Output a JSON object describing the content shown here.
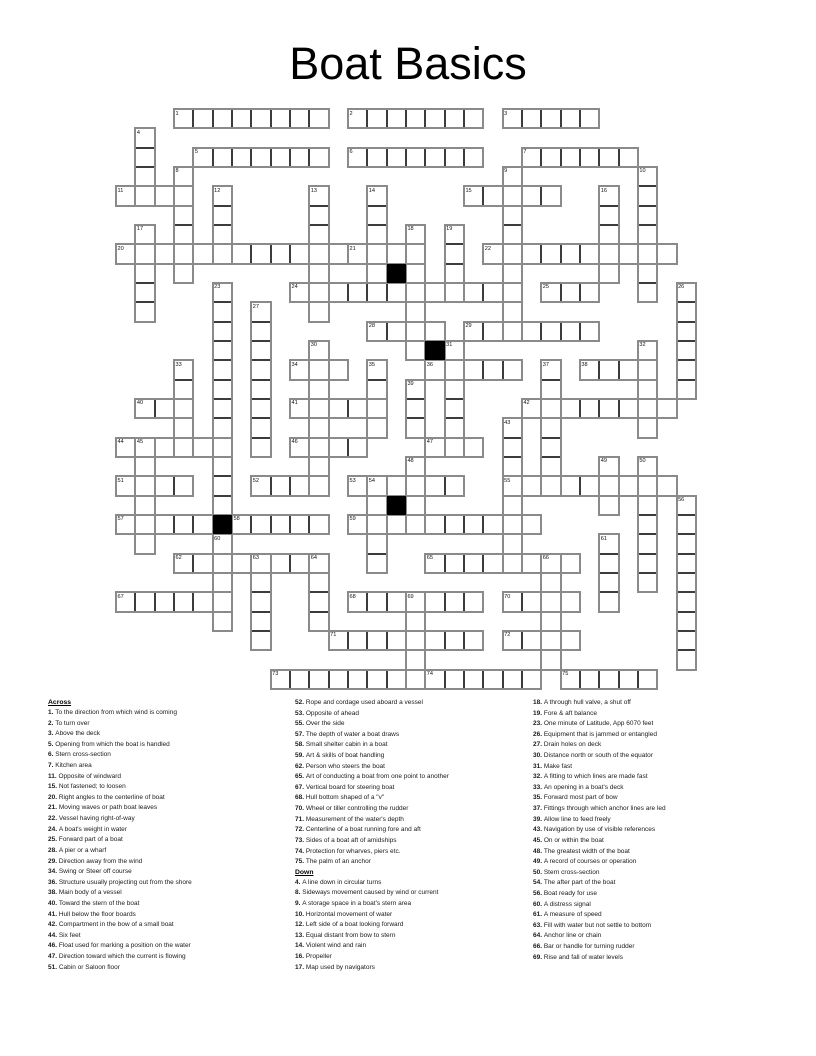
{
  "title": "Boat Basics",
  "grid": {
    "rows": 30,
    "cols": 30,
    "origin_x": 116,
    "origin_y": 109,
    "cell_size": 19.33,
    "colors": {
      "cell_border": "#3c3c3c",
      "word_outline": "#8a8a8a",
      "black_cell": "#000000",
      "cell_bg": "#ffffff"
    },
    "black_cells": [
      [
        8,
        14
      ],
      [
        12,
        16
      ],
      [
        20,
        14
      ],
      [
        21,
        5
      ]
    ],
    "words": [
      {
        "num": 1,
        "dir": "across",
        "row": 0,
        "col": 3,
        "len": 8
      },
      {
        "num": 2,
        "dir": "across",
        "row": 0,
        "col": 12,
        "len": 7
      },
      {
        "num": 3,
        "dir": "across",
        "row": 0,
        "col": 20,
        "len": 5
      },
      {
        "num": 4,
        "dir": "down",
        "row": 1,
        "col": 1,
        "len": 4
      },
      {
        "num": 5,
        "dir": "across",
        "row": 2,
        "col": 4,
        "len": 7
      },
      {
        "num": 6,
        "dir": "across",
        "row": 2,
        "col": 12,
        "len": 7
      },
      {
        "num": 7,
        "dir": "across",
        "row": 2,
        "col": 21,
        "len": 6
      },
      {
        "num": 8,
        "dir": "down",
        "row": 3,
        "col": 3,
        "len": 6
      },
      {
        "num": 9,
        "dir": "down",
        "row": 3,
        "col": 20,
        "len": 9
      },
      {
        "num": 10,
        "dir": "down",
        "row": 3,
        "col": 27,
        "len": 7
      },
      {
        "num": 11,
        "dir": "across",
        "row": 4,
        "col": 0,
        "len": 4
      },
      {
        "num": 12,
        "dir": "down",
        "row": 4,
        "col": 5,
        "len": 4
      },
      {
        "num": 13,
        "dir": "down",
        "row": 4,
        "col": 10,
        "len": 7
      },
      {
        "num": 14,
        "dir": "down",
        "row": 4,
        "col": 13,
        "len": 5
      },
      {
        "num": 15,
        "dir": "across",
        "row": 4,
        "col": 18,
        "len": 5
      },
      {
        "num": 16,
        "dir": "down",
        "row": 4,
        "col": 25,
        "len": 5
      },
      {
        "num": 17,
        "dir": "down",
        "row": 6,
        "col": 1,
        "len": 5
      },
      {
        "num": 18,
        "dir": "down",
        "row": 6,
        "col": 15,
        "len": 7
      },
      {
        "num": 19,
        "dir": "down",
        "row": 6,
        "col": 17,
        "len": 4
      },
      {
        "num": 20,
        "dir": "across",
        "row": 7,
        "col": 0,
        "len": 12
      },
      {
        "num": 21,
        "dir": "across",
        "row": 7,
        "col": 12,
        "len": 4
      },
      {
        "num": 22,
        "dir": "across",
        "row": 7,
        "col": 19,
        "len": 10
      },
      {
        "num": 23,
        "dir": "down",
        "row": 9,
        "col": 5,
        "len": 12
      },
      {
        "num": 24,
        "dir": "across",
        "row": 9,
        "col": 9,
        "len": 12
      },
      {
        "num": 25,
        "dir": "across",
        "row": 9,
        "col": 22,
        "len": 3
      },
      {
        "num": 26,
        "dir": "down",
        "row": 9,
        "col": 29,
        "len": 6
      },
      {
        "num": 27,
        "dir": "down",
        "row": 10,
        "col": 7,
        "len": 8
      },
      {
        "num": 28,
        "dir": "across",
        "row": 11,
        "col": 13,
        "len": 4
      },
      {
        "num": 29,
        "dir": "across",
        "row": 11,
        "col": 18,
        "len": 7
      },
      {
        "num": 30,
        "dir": "down",
        "row": 12,
        "col": 10,
        "len": 8
      },
      {
        "num": 31,
        "dir": "down",
        "row": 12,
        "col": 17,
        "len": 6
      },
      {
        "num": 32,
        "dir": "down",
        "row": 12,
        "col": 27,
        "len": 5
      },
      {
        "num": 33,
        "dir": "down",
        "row": 13,
        "col": 3,
        "len": 5
      },
      {
        "num": 34,
        "dir": "across",
        "row": 13,
        "col": 9,
        "len": 3
      },
      {
        "num": 35,
        "dir": "down",
        "row": 13,
        "col": 13,
        "len": 4
      },
      {
        "num": 36,
        "dir": "across",
        "row": 13,
        "col": 16,
        "len": 5
      },
      {
        "num": 37,
        "dir": "down",
        "row": 13,
        "col": 22,
        "len": 7
      },
      {
        "num": 38,
        "dir": "across",
        "row": 13,
        "col": 24,
        "len": 4
      },
      {
        "num": 39,
        "dir": "down",
        "row": 14,
        "col": 15,
        "len": 3
      },
      {
        "num": 40,
        "dir": "across",
        "row": 15,
        "col": 1,
        "len": 3
      },
      {
        "num": 41,
        "dir": "across",
        "row": 15,
        "col": 9,
        "len": 5
      },
      {
        "num": 42,
        "dir": "across",
        "row": 15,
        "col": 21,
        "len": 8
      },
      {
        "num": 43,
        "dir": "down",
        "row": 16,
        "col": 20,
        "len": 8
      },
      {
        "num": 44,
        "dir": "across",
        "row": 17,
        "col": 0,
        "len": 6
      },
      {
        "num": 45,
        "dir": "down",
        "row": 17,
        "col": 1,
        "len": 6
      },
      {
        "num": 46,
        "dir": "across",
        "row": 17,
        "col": 9,
        "len": 4
      },
      {
        "num": 47,
        "dir": "across",
        "row": 17,
        "col": 16,
        "len": 3
      },
      {
        "num": 48,
        "dir": "down",
        "row": 18,
        "col": 15,
        "len": 4
      },
      {
        "num": 49,
        "dir": "down",
        "row": 18,
        "col": 25,
        "len": 3
      },
      {
        "num": 50,
        "dir": "down",
        "row": 18,
        "col": 27,
        "len": 7
      },
      {
        "num": 51,
        "dir": "across",
        "row": 19,
        "col": 0,
        "len": 4
      },
      {
        "num": 52,
        "dir": "across",
        "row": 19,
        "col": 7,
        "len": 4
      },
      {
        "num": 53,
        "dir": "across",
        "row": 19,
        "col": 12,
        "len": 6
      },
      {
        "num": 54,
        "dir": "down",
        "row": 19,
        "col": 13,
        "len": 5
      },
      {
        "num": 55,
        "dir": "across",
        "row": 19,
        "col": 20,
        "len": 9
      },
      {
        "num": 56,
        "dir": "down",
        "row": 20,
        "col": 29,
        "len": 9
      },
      {
        "num": 57,
        "dir": "across",
        "row": 21,
        "col": 0,
        "len": 5
      },
      {
        "num": 58,
        "dir": "across",
        "row": 21,
        "col": 6,
        "len": 5
      },
      {
        "num": 59,
        "dir": "across",
        "row": 21,
        "col": 12,
        "len": 10
      },
      {
        "num": 60,
        "dir": "down",
        "row": 22,
        "col": 5,
        "len": 5
      },
      {
        "num": 61,
        "dir": "down",
        "row": 22,
        "col": 25,
        "len": 4
      },
      {
        "num": 62,
        "dir": "across",
        "row": 23,
        "col": 3,
        "len": 8
      },
      {
        "num": 63,
        "dir": "down",
        "row": 23,
        "col": 7,
        "len": 5
      },
      {
        "num": 64,
        "dir": "down",
        "row": 23,
        "col": 10,
        "len": 4
      },
      {
        "num": 65,
        "dir": "across",
        "row": 23,
        "col": 16,
        "len": 8
      },
      {
        "num": 66,
        "dir": "down",
        "row": 23,
        "col": 22,
        "len": 6
      },
      {
        "num": 67,
        "dir": "across",
        "row": 25,
        "col": 0,
        "len": 6
      },
      {
        "num": 68,
        "dir": "across",
        "row": 25,
        "col": 12,
        "len": 7
      },
      {
        "num": 69,
        "dir": "down",
        "row": 25,
        "col": 15,
        "len": 5
      },
      {
        "num": 70,
        "dir": "across",
        "row": 25,
        "col": 20,
        "len": 4
      },
      {
        "num": 71,
        "dir": "across",
        "row": 27,
        "col": 11,
        "len": 8
      },
      {
        "num": 72,
        "dir": "across",
        "row": 27,
        "col": 20,
        "len": 4
      },
      {
        "num": 73,
        "dir": "across",
        "row": 29,
        "col": 8,
        "len": 8
      },
      {
        "num": 74,
        "dir": "across",
        "row": 29,
        "col": 16,
        "len": 6
      },
      {
        "num": 75,
        "dir": "across",
        "row": 29,
        "col": 23,
        "len": 5
      }
    ]
  },
  "clues": {
    "across_label": "Across",
    "down_label": "Down",
    "across": [
      {
        "num": "1.",
        "text": "To the direction from which wind is coming"
      },
      {
        "num": "2.",
        "text": "To turn over"
      },
      {
        "num": "3.",
        "text": "Above the deck"
      },
      {
        "num": "5.",
        "text": "Opening from which the boat is handled"
      },
      {
        "num": "6.",
        "text": "Stern cross-section"
      },
      {
        "num": "7.",
        "text": "Kitchen area"
      },
      {
        "num": "11.",
        "text": "Opposite of windward"
      },
      {
        "num": "15.",
        "text": "Not fastened; to loosen"
      },
      {
        "num": "20.",
        "text": "Right angles to the centerline of boat"
      },
      {
        "num": "21.",
        "text": "Moving waves or path boat leaves"
      },
      {
        "num": "22.",
        "text": "Vessel having right-of-way"
      },
      {
        "num": "24.",
        "text": "A boat's weight in water"
      },
      {
        "num": "25.",
        "text": "Forward part of a boat"
      },
      {
        "num": "28.",
        "text": "A pier or a wharf"
      },
      {
        "num": "29.",
        "text": "Direction away from the wind"
      },
      {
        "num": "34.",
        "text": "Swing or Steer off course"
      },
      {
        "num": "36.",
        "text": "Structure usually projecting out from the shore"
      },
      {
        "num": "38.",
        "text": "Main body of a vessel"
      },
      {
        "num": "40.",
        "text": "Toward the stern of the boat"
      },
      {
        "num": "41.",
        "text": "Hull below the floor boards"
      },
      {
        "num": "42.",
        "text": "Compartment in the bow of a small boat"
      },
      {
        "num": "44.",
        "text": "Six feet"
      },
      {
        "num": "46.",
        "text": "Float used for marking a position on the water"
      },
      {
        "num": "47.",
        "text": "Direction toward which the current is flowing"
      },
      {
        "num": "51.",
        "text": "Cabin or Saloon floor"
      },
      {
        "num": "52.",
        "text": "Rope and cordage used aboard a vessel"
      },
      {
        "num": "53.",
        "text": "Opposite of ahead"
      },
      {
        "num": "55.",
        "text": "Over the side"
      },
      {
        "num": "57.",
        "text": "The depth of water a boat draws"
      },
      {
        "num": "58.",
        "text": "Small shelter cabin in a boat"
      },
      {
        "num": "59.",
        "text": "Art & skills of boat handling"
      },
      {
        "num": "62.",
        "text": "Person who steers the boat"
      },
      {
        "num": "65.",
        "text": "Art of conducting a boat from one point to another"
      },
      {
        "num": "67.",
        "text": "Vertical board for steering boat"
      },
      {
        "num": "68.",
        "text": "Hull bottom shaped of a \"v\""
      },
      {
        "num": "70.",
        "text": "Wheel or tiller controlling the rudder"
      },
      {
        "num": "71.",
        "text": "Measurement of the water's depth"
      },
      {
        "num": "72.",
        "text": "Centerline of a boat running fore and aft"
      },
      {
        "num": "73.",
        "text": "Sides of a boat aft of amidships"
      },
      {
        "num": "74.",
        "text": "Protection for wharves, piers etc."
      },
      {
        "num": "75.",
        "text": "The palm of an anchor"
      }
    ],
    "down": [
      {
        "num": "4.",
        "text": "A line down in circular turns"
      },
      {
        "num": "8.",
        "text": "Sideways movement caused by wind or current"
      },
      {
        "num": "9.",
        "text": "A storage space in a boat's stern area"
      },
      {
        "num": "10.",
        "text": "Horizontal movement of water"
      },
      {
        "num": "12.",
        "text": "Left side of a boat looking forward"
      },
      {
        "num": "13.",
        "text": "Equal distant from bow to stern"
      },
      {
        "num": "14.",
        "text": "Violent wind and rain"
      },
      {
        "num": "16.",
        "text": "Propeller"
      },
      {
        "num": "17.",
        "text": "Map used by navigators"
      },
      {
        "num": "18.",
        "text": "A through hull valve, a shut off"
      },
      {
        "num": "19.",
        "text": "Fore & aft balance"
      },
      {
        "num": "23.",
        "text": "One minute of Latitude, App 6070 feet"
      },
      {
        "num": "26.",
        "text": "Equipment that is jammed or entangled"
      },
      {
        "num": "27.",
        "text": "Drain holes on deck"
      },
      {
        "num": "30.",
        "text": "Distance north or south of the equator"
      },
      {
        "num": "31.",
        "text": "Make fast"
      },
      {
        "num": "32.",
        "text": "A fitting to which lines are made fast"
      },
      {
        "num": "33.",
        "text": "An opening in a boat's deck"
      },
      {
        "num": "35.",
        "text": "Forward most part of bow"
      },
      {
        "num": "37.",
        "text": "Fittings through which anchor lines are led"
      },
      {
        "num": "39.",
        "text": "Allow line to feed freely"
      },
      {
        "num": "43.",
        "text": "Navigation by use of visible references"
      },
      {
        "num": "45.",
        "text": "On or within the boat"
      },
      {
        "num": "48.",
        "text": "The greatest width of the boat"
      },
      {
        "num": "49.",
        "text": "A record of courses or operation"
      },
      {
        "num": "50.",
        "text": "Stern cross-section"
      },
      {
        "num": "54.",
        "text": "The after part of the boat"
      },
      {
        "num": "56.",
        "text": "Boat ready for use"
      },
      {
        "num": "60.",
        "text": "A distress signal"
      },
      {
        "num": "61.",
        "text": "A measure of speed"
      },
      {
        "num": "63.",
        "text": "Fill with water but not settle to bottom"
      },
      {
        "num": "64.",
        "text": "Anchor line or chain"
      },
      {
        "num": "66.",
        "text": "Bar or handle for turning rudder"
      },
      {
        "num": "69.",
        "text": "Rise and fall of water levels"
      }
    ]
  }
}
